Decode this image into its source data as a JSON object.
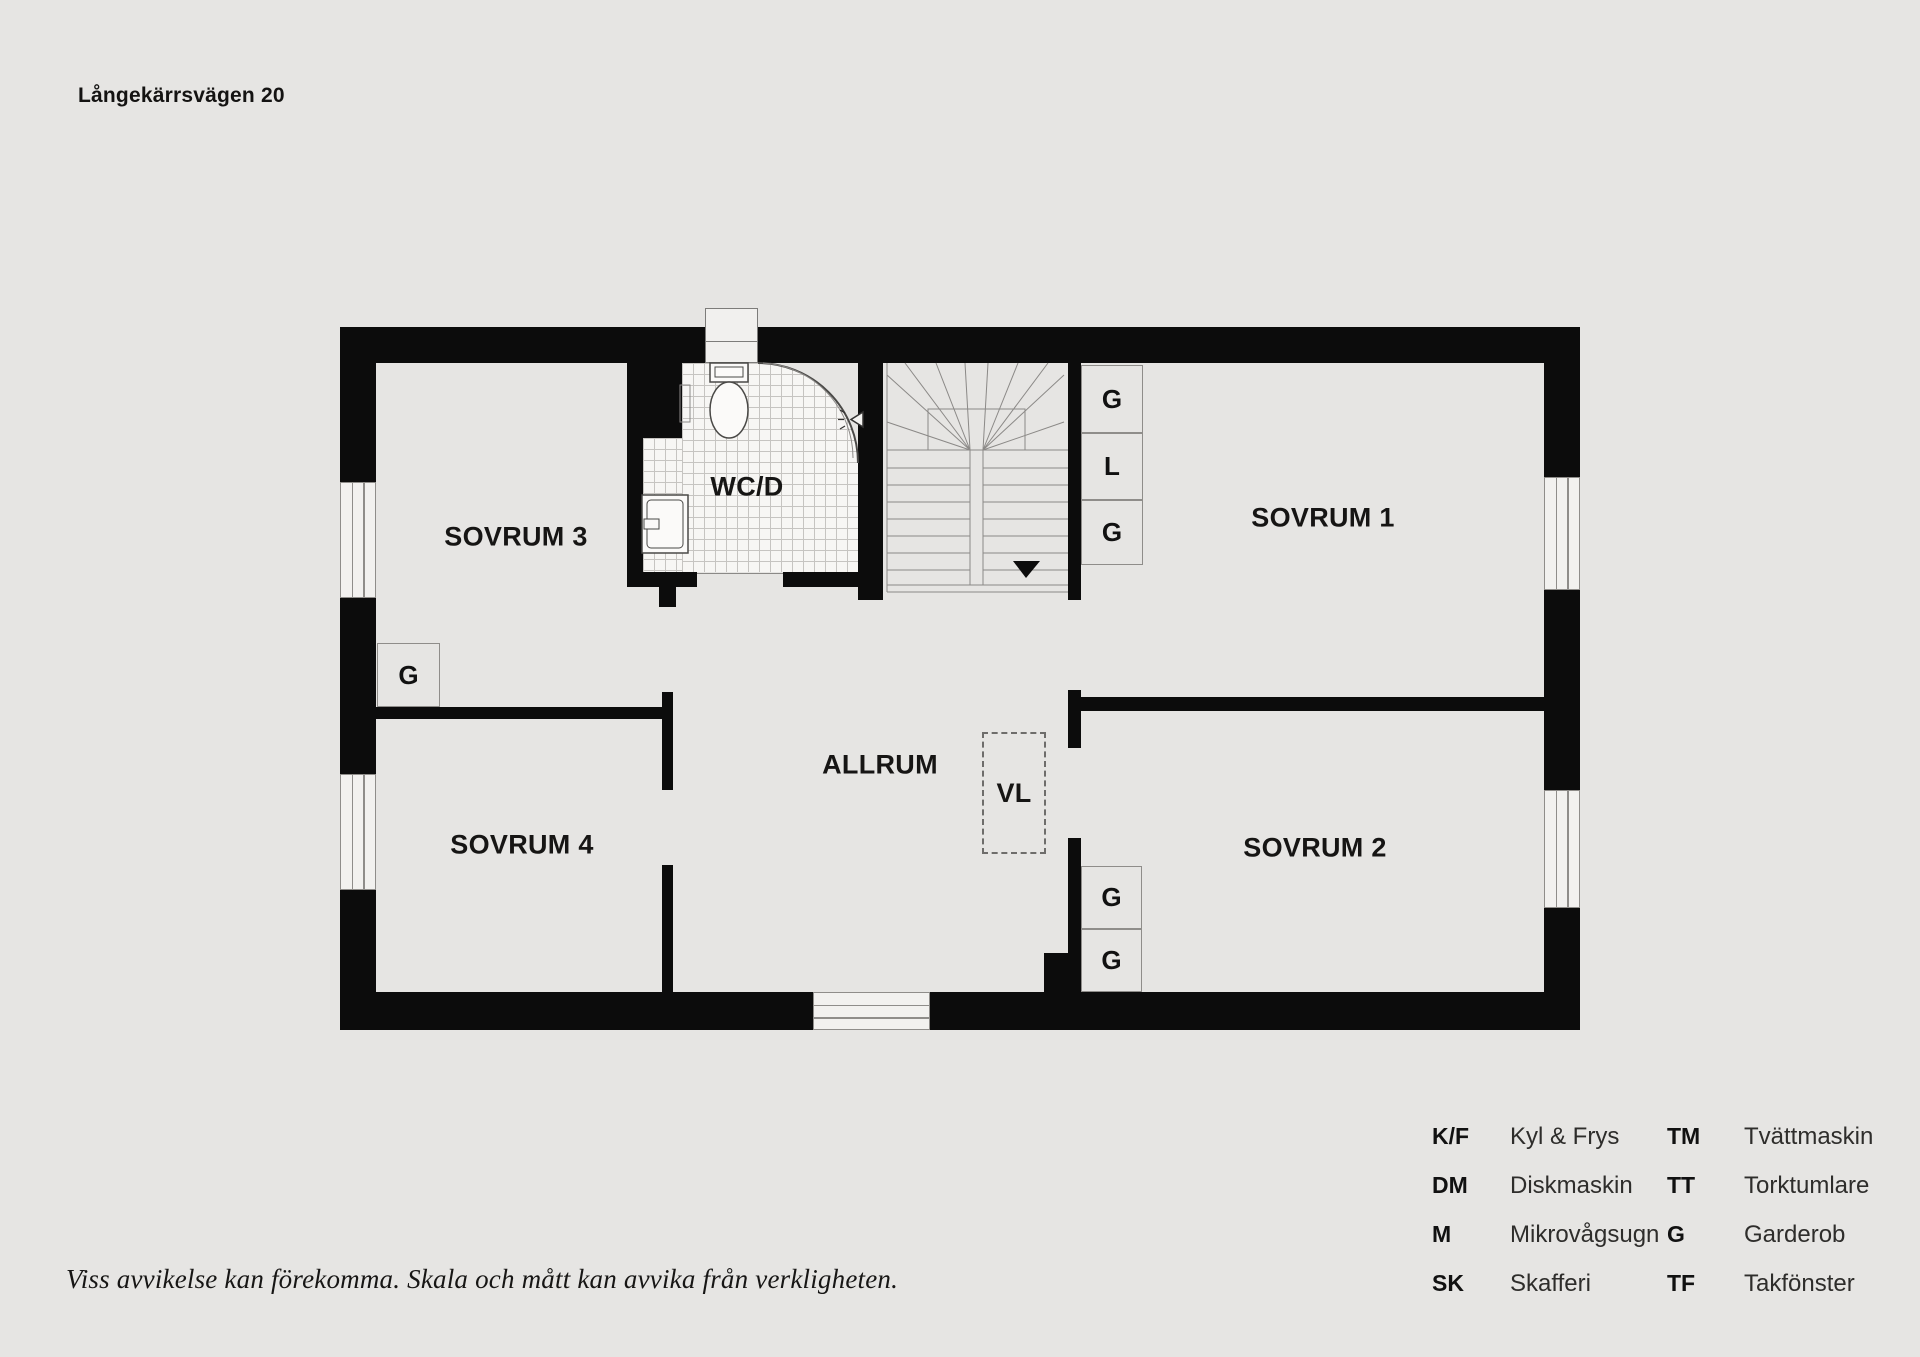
{
  "page": {
    "title": "Långekärrsvägen 20",
    "disclaimer": "Viss avvikelse kan förekomma. Skala och mått kan avvika från verkligheten.",
    "background_color": "#e6e5e3",
    "wall_color": "#0c0c0c"
  },
  "floorplan": {
    "rooms": {
      "sovrum1": "SOVRUM 1",
      "sovrum2": "SOVRUM 2",
      "sovrum3": "SOVRUM 3",
      "sovrum4": "SOVRUM 4",
      "allrum": "ALLRUM",
      "wcd": "WC/D",
      "vl": "VL"
    },
    "closets": {
      "stair_top": "G",
      "stair_mid": "L",
      "stair_bottom": "G",
      "sovrum2_top": "G",
      "sovrum2_bottom": "G",
      "sovrum3": "G"
    },
    "symbols": {
      "stair_direction": "down-arrow"
    }
  },
  "legend": {
    "rows": [
      {
        "abbr1": "K/F",
        "name1": "Kyl & Frys",
        "abbr2": "TM",
        "name2": "Tvättmaskin"
      },
      {
        "abbr1": "DM",
        "name1": "Diskmaskin",
        "abbr2": "TT",
        "name2": "Torktumlare"
      },
      {
        "abbr1": "M",
        "name1": "Mikrovågsugn",
        "abbr2": "G",
        "name2": "Garderob"
      },
      {
        "abbr1": "SK",
        "name1": "Skafferi",
        "abbr2": "TF",
        "name2": "Takfönster"
      }
    ]
  }
}
